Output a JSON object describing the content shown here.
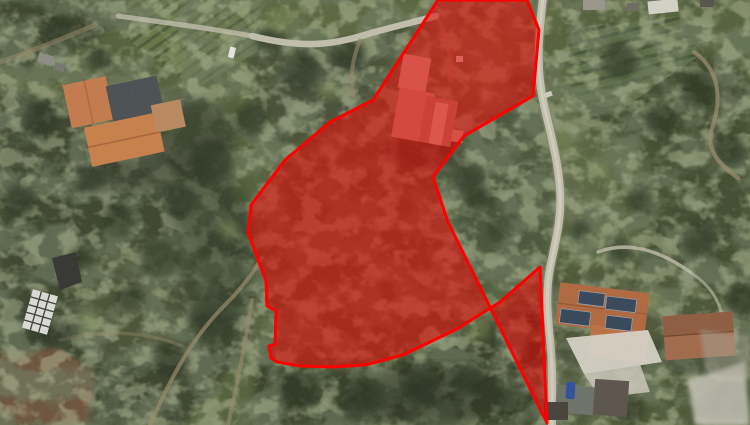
{
  "canvas": {
    "width": 750,
    "height": 425
  },
  "parcel_overlay": {
    "label": "highlighted-land-parcel",
    "stroke_color": "#ff0000",
    "stroke_width": "3",
    "fill_color": "#e60000",
    "fill_opacity": "0.55",
    "points": "438,0 527,0 539,30 533,96 464,136 433,177 448,222 547,423 540,267 500,302 457,329 403,355 365,365 333,367 300,366 277,362 271,358 269,346 275,344 276,311 267,306 266,281 248,233 251,205 285,160 330,122 373,100"
  },
  "palette": {
    "--terrain-base": "#55613d",
    "--wood-dark": "#39422c",
    "--road-light": "#c3bfae",
    "--trail-tan": "#998b6b",
    "--roof-orange": "#c47a4c",
    "--roof-dark": "#4a4f53",
    "--roof-terracotta": "#b2683e",
    "--roof-brown": "#a26a4a",
    "--solar-blue": "#36465a",
    "--white-roof": "#d8d5ca",
    "--field-brown": "#76573f",
    "--overlay-red": "#ff0000"
  }
}
